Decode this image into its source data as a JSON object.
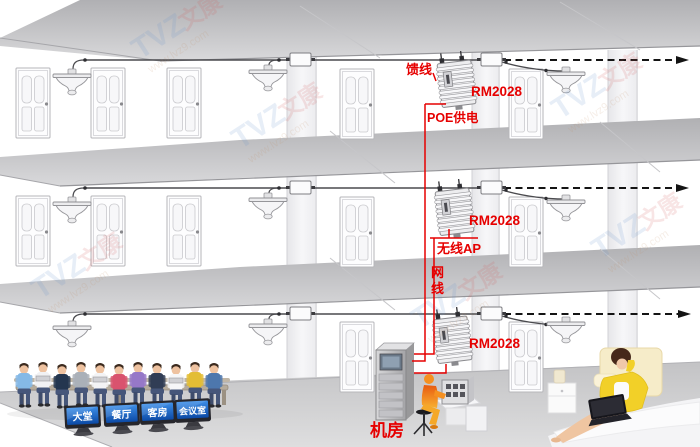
{
  "diagram": {
    "floors": [
      {
        "device": "RM2028"
      },
      {
        "device": "RM2028"
      },
      {
        "device": "RM2028"
      }
    ],
    "callouts": {
      "feeder": "馈线",
      "poe": "POE供电",
      "wireless_ap": "无线AP",
      "net_cable_line1": "网",
      "net_cable_line2": "线",
      "machine_room": "机房"
    },
    "rooms": [
      {
        "label": "大堂"
      },
      {
        "label": "餐厅"
      },
      {
        "label": "客房"
      },
      {
        "label": "会议室"
      }
    ],
    "watermark": {
      "brand": "TVZ",
      "brand_cn": "文康",
      "url": "www.lvz9.com"
    },
    "colors": {
      "annotation_red": "#e60000",
      "monitor_screen_blue": "#1668c8",
      "operator_orange": "#f08010",
      "slab_gray": "#c4c4c6"
    }
  }
}
